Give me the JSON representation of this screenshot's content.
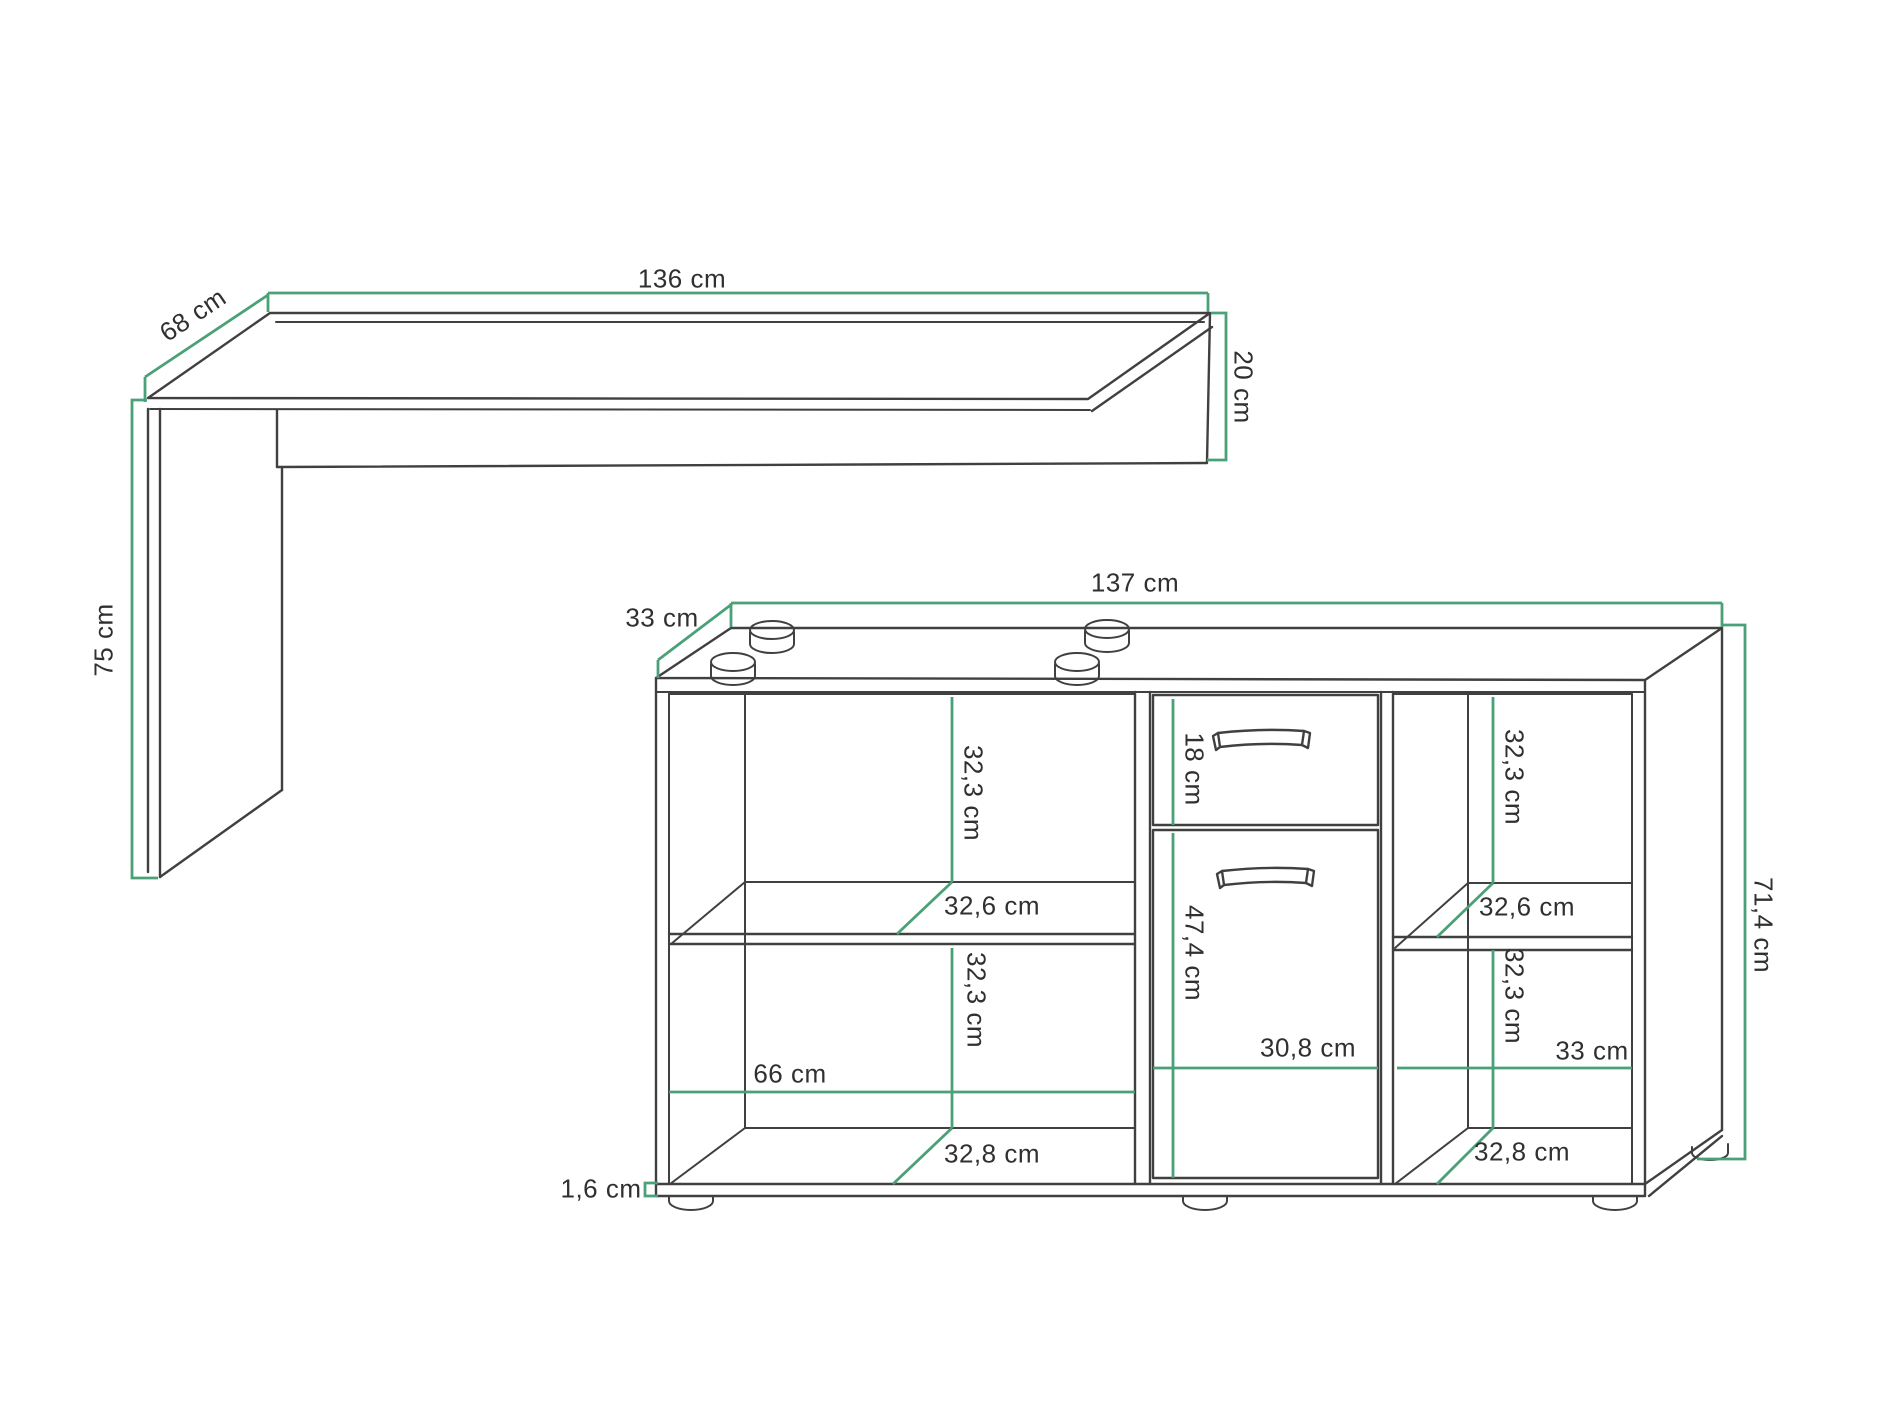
{
  "diagram": {
    "title": "furniture-dimension-drawing",
    "accent_color": "#4aa178",
    "line_color": "#404040",
    "text_color": "#303030",
    "background_color": "#ffffff",
    "units": "cm",
    "labels": {
      "desk_width": "136 cm",
      "desk_depth": "68 cm",
      "desk_apron_height": "20 cm",
      "desk_height": "75 cm",
      "cab_width": "137 cm",
      "cab_depth": "33 cm",
      "cab_height": "71,4 cm",
      "left_upper_height": "32,3 cm",
      "left_shelf_depth": "32,6 cm",
      "left_lower_height": "32,3 cm",
      "left_width": "66 cm",
      "left_bottom_depth": "32,8 cm",
      "drawer_height": "18 cm",
      "door_height": "47,4 cm",
      "middle_width": "30,8 cm",
      "right_upper_height": "32,3 cm",
      "right_shelf_depth": "32,6 cm",
      "right_lower_height": "32,3 cm",
      "right_width": "33 cm",
      "right_bottom_depth": "32,8 cm",
      "bottom_panel_thickness": "1,6 cm"
    }
  }
}
